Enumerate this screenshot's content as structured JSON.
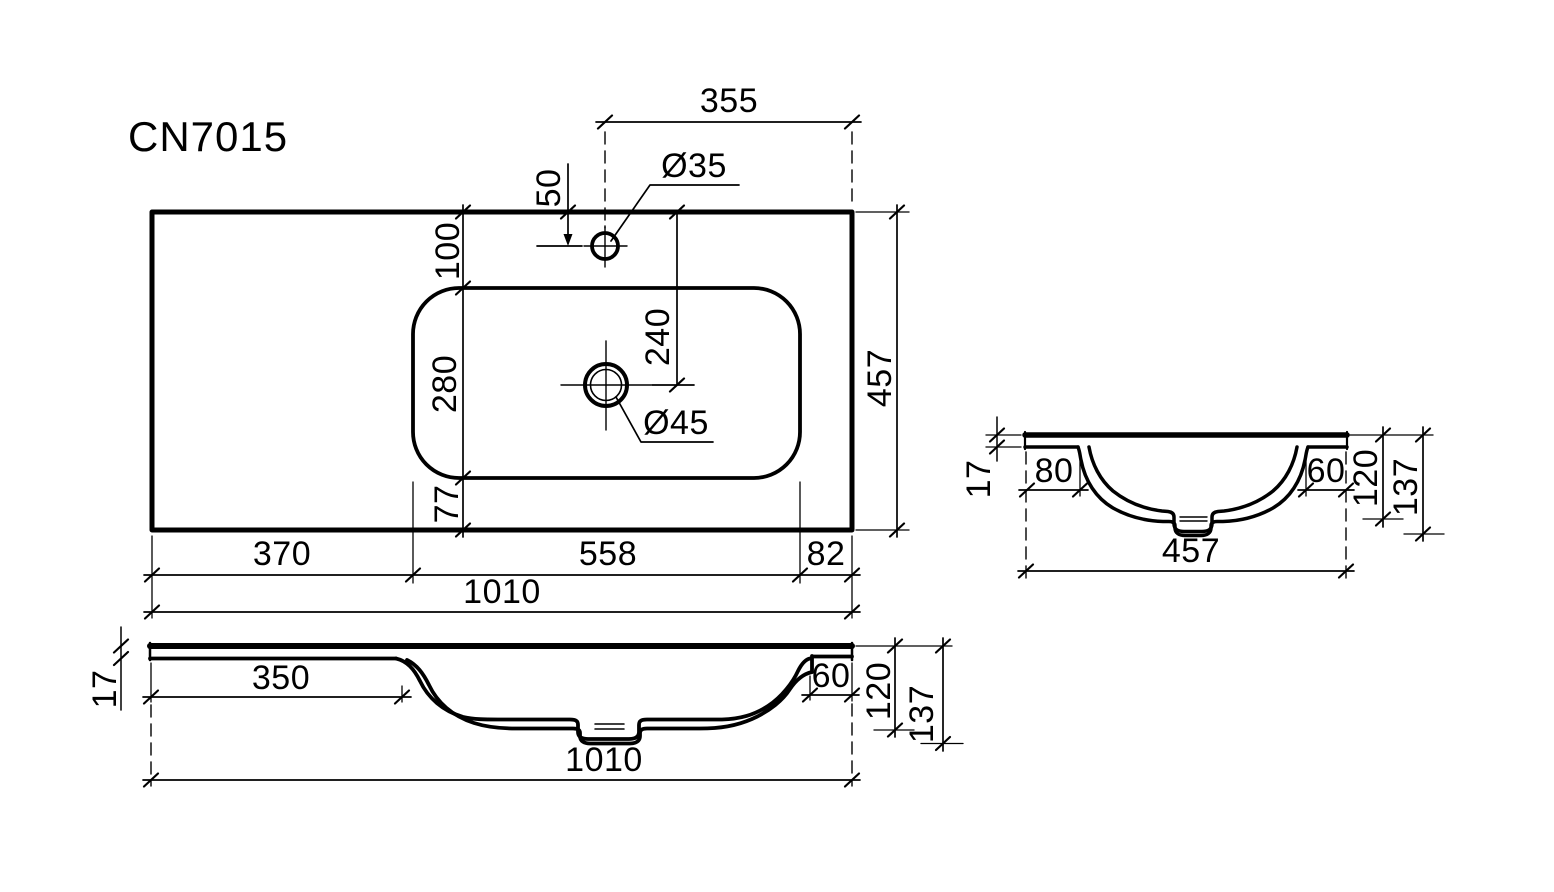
{
  "title": "CN7015",
  "colors": {
    "ink": "#000000",
    "paper": "#ffffff"
  },
  "top_view": {
    "dim_top_width": "355",
    "dim_faucet_offset": "50",
    "label_faucet_hole": "Ø35",
    "dim_deck_back": "100",
    "dim_basin_length": "280",
    "dim_deck_front": "77",
    "dim_drain_offset": "240",
    "label_drain_hole": "Ø45",
    "dim_overall_depth": "457",
    "dim_deck_left": "370",
    "dim_basin_width": "558",
    "dim_deck_right": "82",
    "dim_overall_width": "1010"
  },
  "front_section": {
    "dim_thickness": "17",
    "dim_left_flat": "350",
    "dim_right_ledge": "60",
    "dim_basin_depth": "120",
    "dim_overall_depth": "137",
    "dim_overall_width": "1010"
  },
  "side_section": {
    "dim_thickness": "17",
    "dim_left_ledge": "80",
    "dim_right_ledge": "60",
    "dim_basin_depth": "120",
    "dim_overall_depth": "137",
    "dim_overall_width": "457"
  }
}
